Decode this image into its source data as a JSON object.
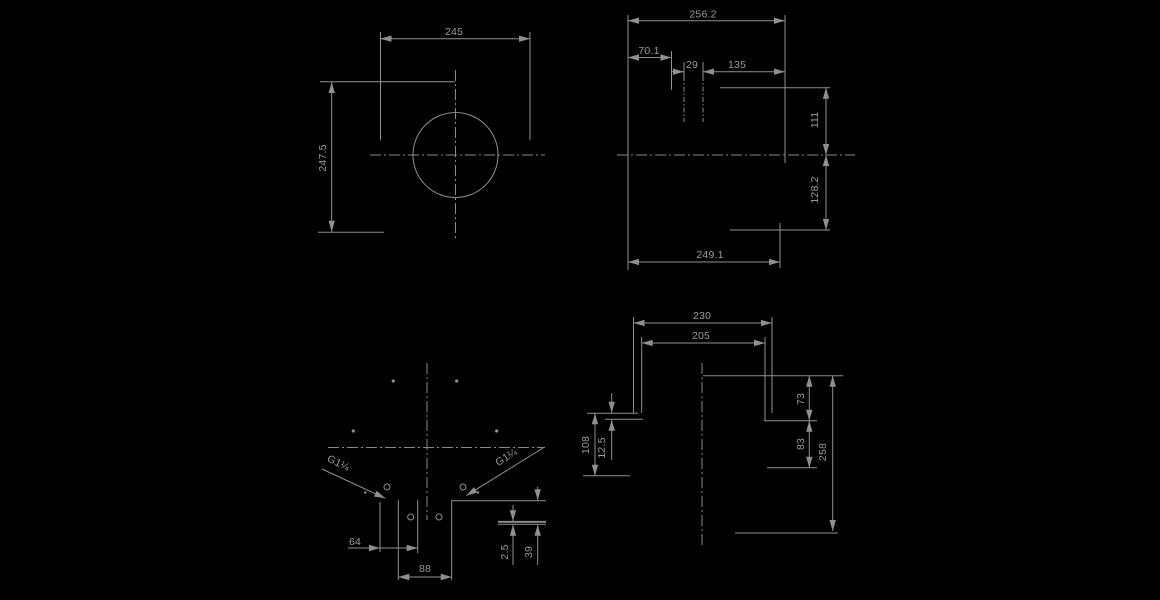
{
  "views": {
    "top_left": {
      "width": "245",
      "height": "247.5"
    },
    "top_right": {
      "overall_width": "256.2",
      "offset_left": "70.1",
      "slot_width": "29",
      "offset_right": "135",
      "height_top": "111",
      "height_bottom": "128.2",
      "width_bottom": "249.1"
    },
    "bottom_left": {
      "spacing_64": "64",
      "width_88": "88",
      "thickness_2_5": "2.5",
      "depth_39": "39",
      "thread_left": "G1¼",
      "thread_right": "G1¼"
    },
    "bottom_right": {
      "width_230": "230",
      "width_205": "205",
      "height_73": "73",
      "height_83": "83",
      "height_258": "258",
      "height_108": "108",
      "step_12_5": "12.5"
    }
  },
  "colors": {
    "background": "#000000",
    "lines": "#8f8f8f",
    "text": "#9a9a9a"
  }
}
